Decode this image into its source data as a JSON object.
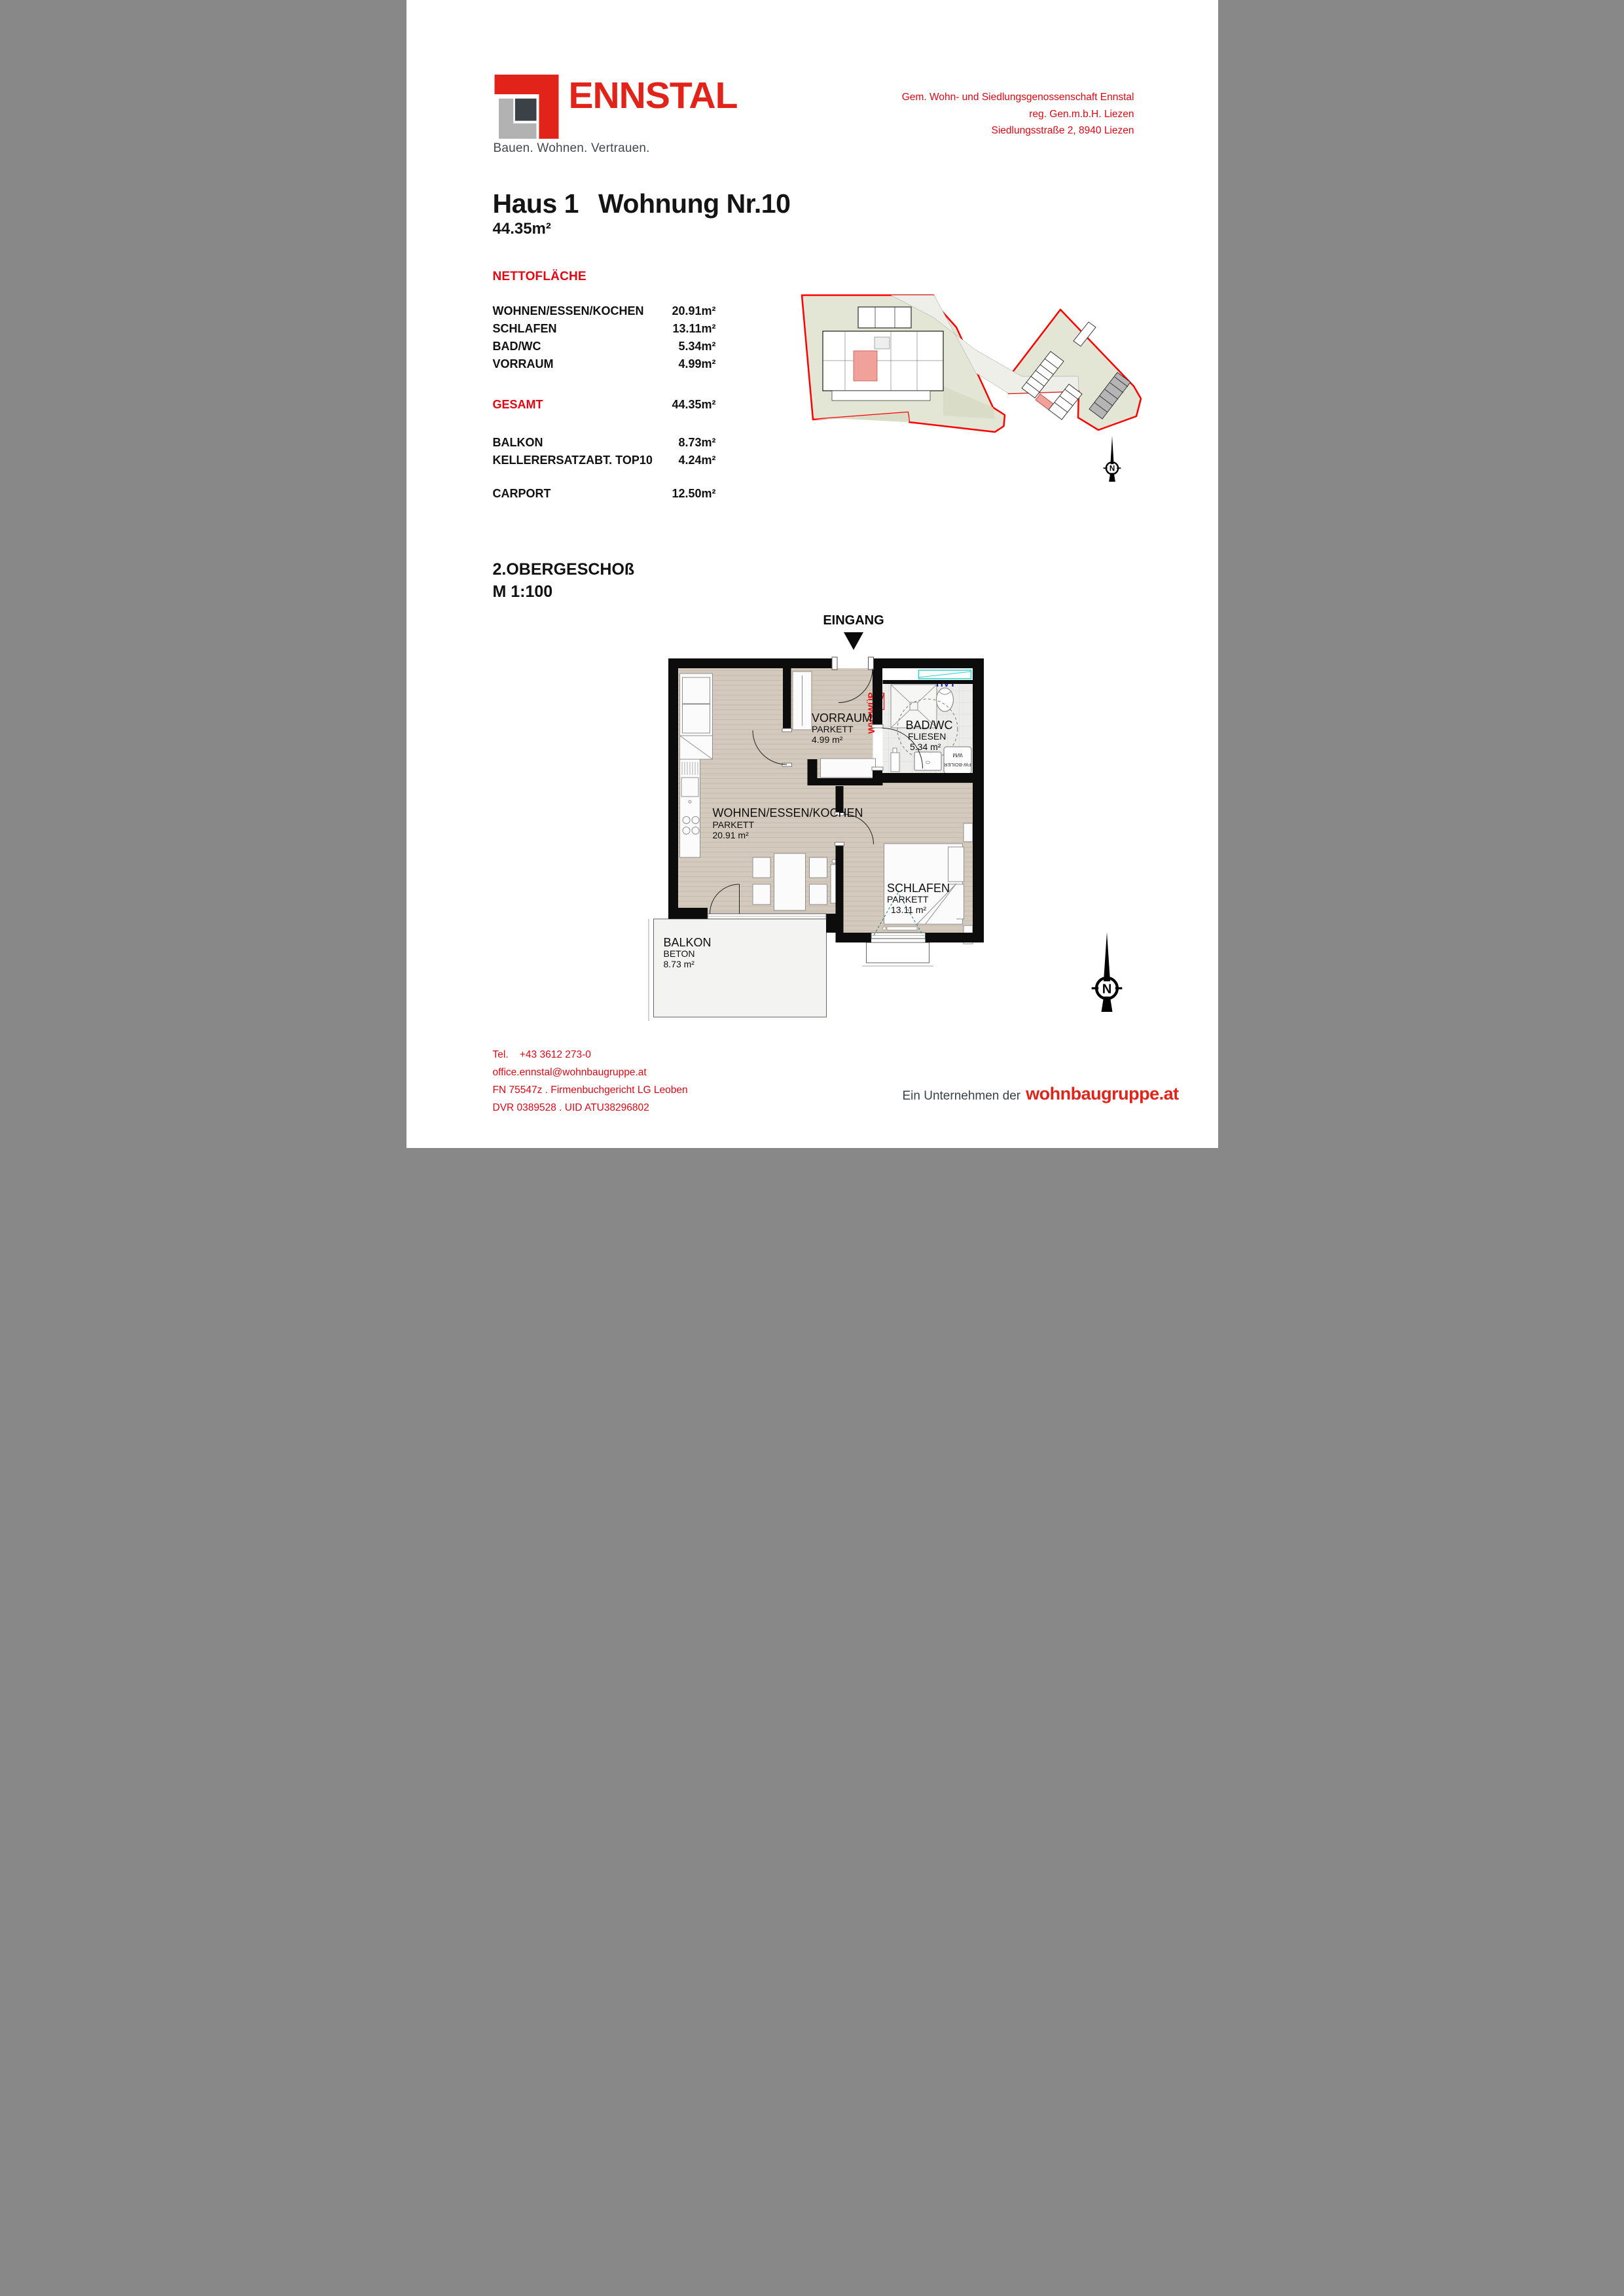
{
  "brand": {
    "logo_text": "ENNSTAL",
    "tagline": "Bauen. Wohnen. Vertrauen.",
    "red": "#e2231a"
  },
  "company": {
    "line1": "Gem. Wohn- und Siedlungsgenossenschaft Ennstal",
    "line2": "reg. Gen.m.b.H. Liezen",
    "line3": "Siedlungsstraße 2, 8940 Liezen"
  },
  "title": {
    "haus": "Haus 1",
    "wohnung": "Wohnung Nr.10",
    "area": "44.35m²"
  },
  "areas": {
    "heading": "NETTOFLÄCHE",
    "rows": [
      {
        "label": "WOHNEN/ESSEN/KOCHEN",
        "value": "20.91m²"
      },
      {
        "label": "SCHLAFEN",
        "value": "13.11m²"
      },
      {
        "label": "BAD/WC",
        "value": "5.34m²"
      },
      {
        "label": "VORRAUM",
        "value": "4.99m²"
      }
    ],
    "gesamt": {
      "label": "GESAMT",
      "value": "44.35m²"
    },
    "extras": [
      {
        "label": "BALKON",
        "value": "8.73m²"
      },
      {
        "label": "KELLERERSATZABT. TOP10",
        "value": "4.24m²"
      }
    ],
    "carport": {
      "label": "CARPORT",
      "value": "12.50m²"
    }
  },
  "floor": {
    "level": "2.OBERGESCHOß",
    "scale": "M  1:100"
  },
  "plan": {
    "eingang": "EINGANG",
    "rooms": {
      "wohnen": {
        "name": "WOHNEN/ESSEN/KOCHEN",
        "floor": "PARKETT",
        "area": "20.91 m²"
      },
      "schlafen": {
        "name": "SCHLAFEN",
        "floor": "PARKETT",
        "area": "13.11 m²"
      },
      "bad": {
        "name": "BAD/WC",
        "floor": "FLIESEN",
        "area": "5.34 m²"
      },
      "vorraum": {
        "name": "VORRAUM",
        "floor": "PARKETT",
        "area": "4.99 m²"
      },
      "balkon": {
        "name": "BALKON",
        "floor": "BETON",
        "area": "8.73 m²"
      }
    },
    "annotations": {
      "wvwup": "WV+WÜP",
      "hvt": "HVT",
      "wm": "WM",
      "boiler": "FW-BOILER"
    },
    "north": "N"
  },
  "footer": {
    "tel_label": "Tel.",
    "tel": "+43 3612 273-0",
    "email": "office.ennstal@wohnbaugruppe.at",
    "registry": "FN 75547z . Firmenbuchgericht LG Leoben",
    "vat": "DVR 0389528 . UID ATU38296802",
    "partner_prefix": "Ein Unternehmen der",
    "partner_brand": "wohnbaugruppe.at"
  },
  "colors": {
    "red": "#e30613",
    "boundary": "#ff0000",
    "highlight_pink": "#f0a19a",
    "cyan": "#2ad2ce",
    "blue": "#1f1fbb"
  }
}
